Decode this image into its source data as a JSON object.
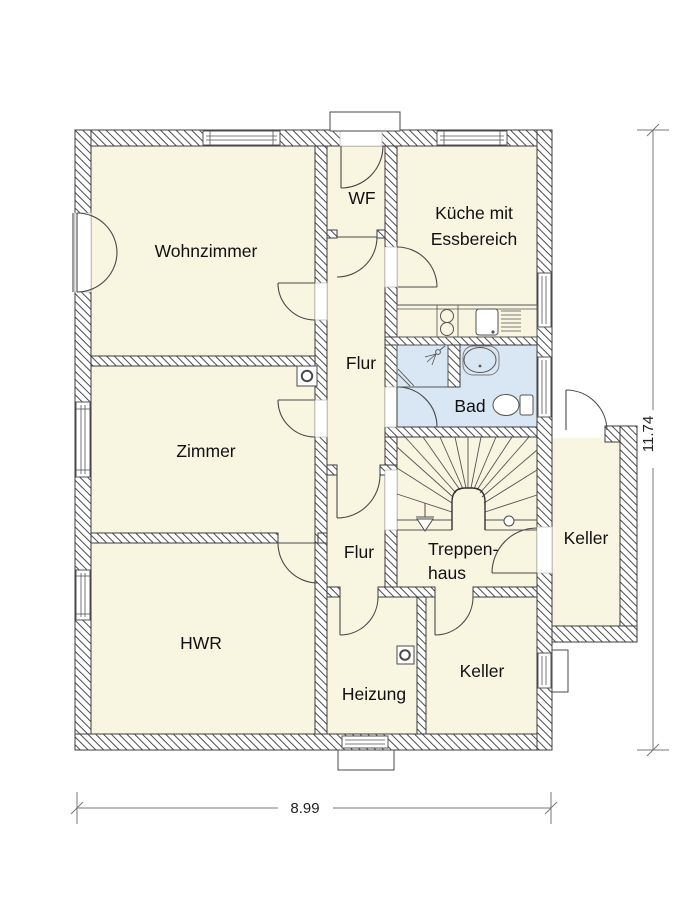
{
  "rooms": {
    "wohnzimmer": {
      "label": "Wohnzimmer"
    },
    "wf": {
      "label": "WF"
    },
    "kueche": {
      "line1": "Küche mit",
      "line2": "Essbereich"
    },
    "flur_oben": {
      "label": "Flur"
    },
    "bad": {
      "label": "Bad"
    },
    "zimmer": {
      "label": "Zimmer"
    },
    "flur_unten": {
      "label": "Flur"
    },
    "treppenhaus": {
      "line1": "Treppen-",
      "line2": "haus"
    },
    "keller_anbau": {
      "label": "Keller"
    },
    "hwr": {
      "label": "HWR"
    },
    "heizung": {
      "label": "Heizung"
    },
    "keller": {
      "label": "Keller"
    }
  },
  "dimensions": {
    "width": "8.99",
    "height": "11.74"
  },
  "colors": {
    "floor": "#f8f5e1",
    "wet": "#d9e6f3",
    "hatch": "#4d4d4d",
    "line": "#3c3c3c",
    "text": "#111111"
  }
}
